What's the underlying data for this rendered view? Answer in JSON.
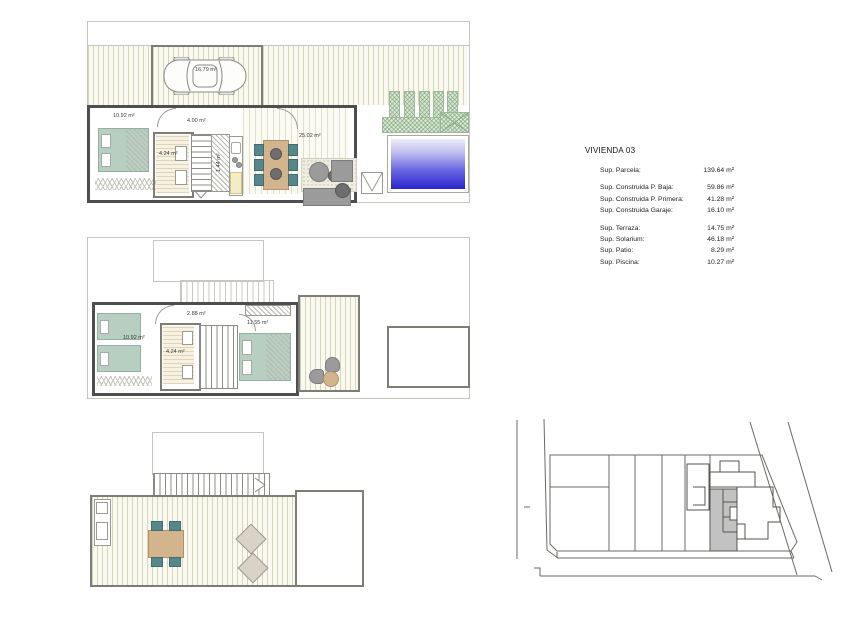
{
  "info_panel": {
    "title": "VIVIENDA 03",
    "rows": [
      {
        "label": "Sup. Parcela:",
        "value": "139.64 m²"
      },
      {
        "label": "Sup. Construida P. Baja:",
        "value": "59.86 m²"
      },
      {
        "label": "Sup. Construida P. Primera:",
        "value": "41.28 m²"
      },
      {
        "label": "Sup. Construida Garaje:",
        "value": "16.10 m²"
      },
      {
        "label": "Sup. Terraza:",
        "value": "14.75 m²"
      },
      {
        "label": "Sup. Solarium:",
        "value": "46.18 m²"
      },
      {
        "label": "Sup. Patio:",
        "value": "8.29 m²"
      },
      {
        "label": "Sup. Piscina:",
        "value": "10.27 m²"
      }
    ]
  },
  "plans": {
    "ground_floor": {
      "labels": {
        "garage": "16.79 m²",
        "bedroom": "10.92 m²",
        "hall": "4.00 m²",
        "bathroom": "4.24 m²",
        "closet": "1.44 m²",
        "living": "25.02 m²"
      }
    },
    "first_floor": {
      "labels": {
        "bedroom": "10.92 m²",
        "hall": "2.88 m²",
        "bathroom": "4.24 m²",
        "master_bedroom": "11.55 m²"
      }
    }
  },
  "colors": {
    "wall": "#4e4e4e",
    "pool_deep": "#2a24cd",
    "garden_green": "#dcead6",
    "furniture_green": "#b6cfc1",
    "site_highlight": "#c2c2c2"
  }
}
